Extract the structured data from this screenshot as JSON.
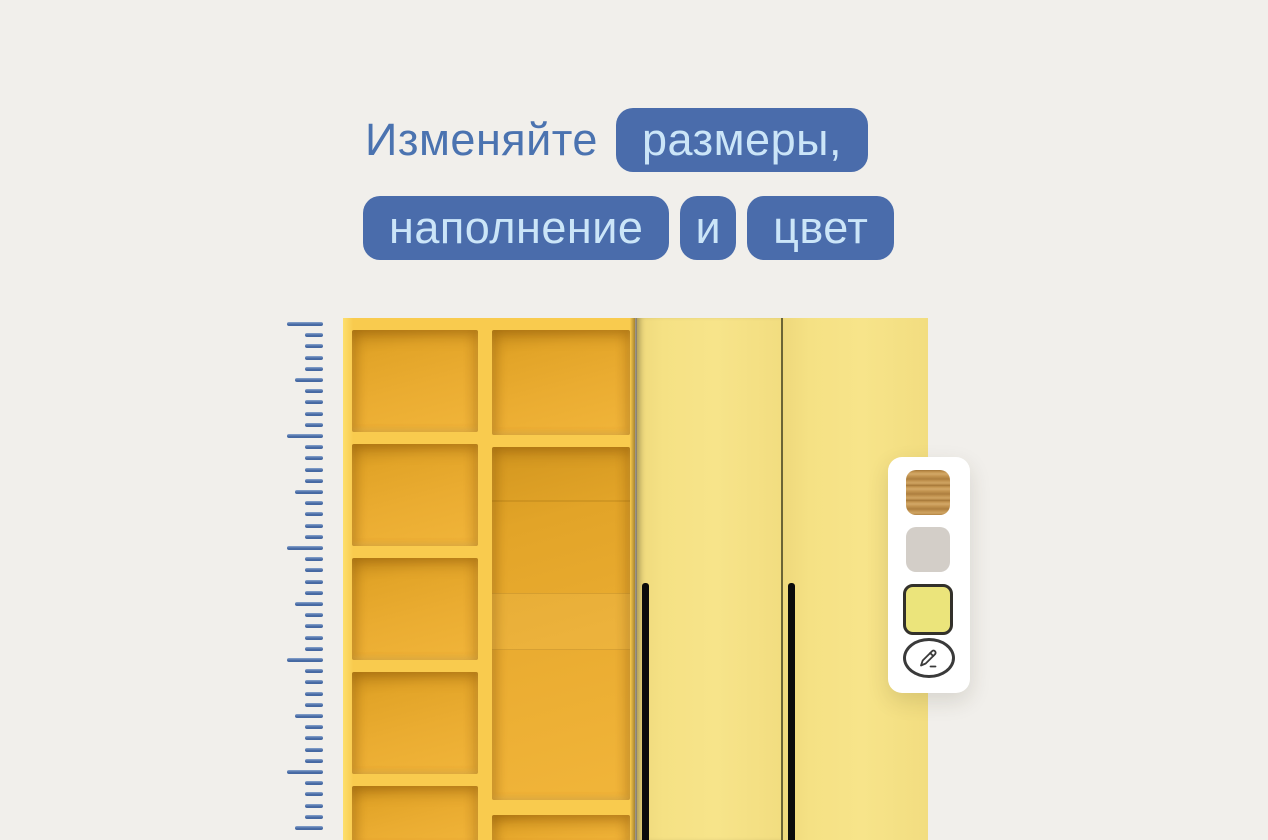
{
  "headline": {
    "line1_plain": "Изменяйте",
    "line1_badge": "размеры,",
    "line2_badge1": "наполнение",
    "line2_badge2": "и",
    "line2_badge3": "цвет"
  },
  "ruler": {
    "tick_count": 46,
    "tick_spacing": 11.2,
    "major_every": 10,
    "medium_every": 5
  },
  "panel": {
    "swatches": [
      {
        "name": "oak-wood",
        "color": "#c49551",
        "selected": false
      },
      {
        "name": "light-gray",
        "color": "#d3cec8",
        "selected": false
      },
      {
        "name": "yellow",
        "color": "#ebe47b",
        "selected": true
      }
    ],
    "edit_icon": "edit-pencil-icon"
  },
  "colors": {
    "background": "#f1efeb",
    "headline_text": "#4b73b0",
    "badge_background": "#4a6cab",
    "badge_text": "#cbe5f8",
    "ruler_blue": "#4a6da6",
    "wardrobe_frame_amber": "#f9cb4e",
    "wardrobe_cell_amber": "#e8a82d",
    "door_pale_yellow": "#f5e184",
    "door_divider": "#6b6435",
    "handle_black": "#0b0b0b",
    "panel_white": "#ffffff",
    "selected_swatch_border": "#33312b"
  }
}
